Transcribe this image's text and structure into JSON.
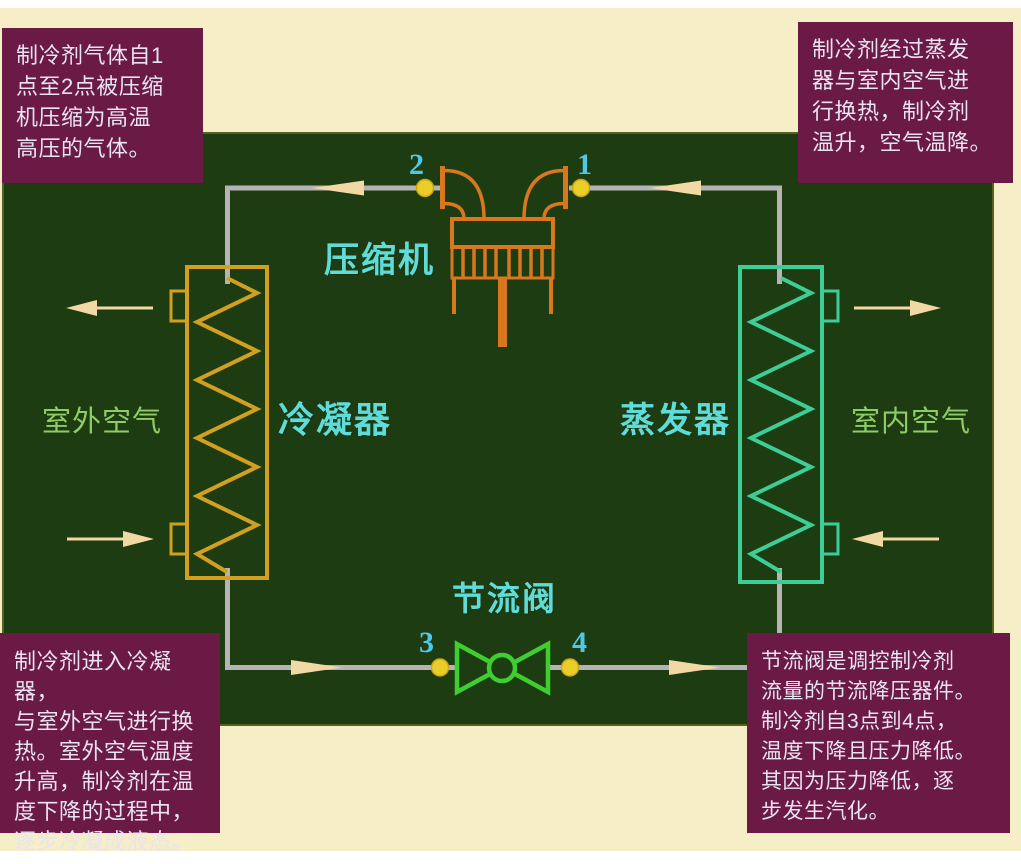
{
  "annotations": {
    "top_left": {
      "text": "制冷剂气体自1\n点至2点被压缩\n机压缩为高温\n高压的气体。"
    },
    "top_right": {
      "text": "制冷剂经过蒸发\n器与室内空气进\n行换热，制冷剂\n温升，空气温降。"
    },
    "bottom_left": {
      "text": "制冷剂进入冷凝器，\n与室外空气进行换\n热。室外空气温度\n升高，制冷剂在温\n度下降的过程中，\n逐步冷凝成液态。"
    },
    "bottom_right": {
      "text": "节流阀是调控制冷剂\n流量的节流降压器件。\n制冷剂自3点到4点，\n温度下降且压力降低。\n其因为压力降低，逐\n步发生汽化。"
    }
  },
  "diagram": {
    "components": {
      "compressor": {
        "label": "压缩机"
      },
      "condenser": {
        "label": "冷凝器"
      },
      "evaporator": {
        "label": "蒸发器"
      },
      "throttle_valve": {
        "label": "节流阀"
      }
    },
    "air_labels": {
      "outdoor": "室外空气",
      "indoor": "室内空气"
    },
    "points": {
      "p1": "1",
      "p2": "2",
      "p3": "3",
      "p4": "4"
    }
  },
  "colors": {
    "page_background": "#FFFFFF",
    "mat_background": "#F5EEC6",
    "board_background": "#1E3C12",
    "annotation_box": "#6B1A45",
    "annotation_text": "#E8E4F0",
    "pipe": "#B4B4B4",
    "flow_arrow": "#F2D8A4",
    "compressor": "#D8771E",
    "condenser": "#D2A021",
    "evaporator": "#3CCE96",
    "throttle_valve": "#3FCE30",
    "component_label": "#5FDCD8",
    "air_label": "#8FCC66",
    "point_number": "#4FC8E8",
    "point_dot": "#EBCD2A"
  }
}
